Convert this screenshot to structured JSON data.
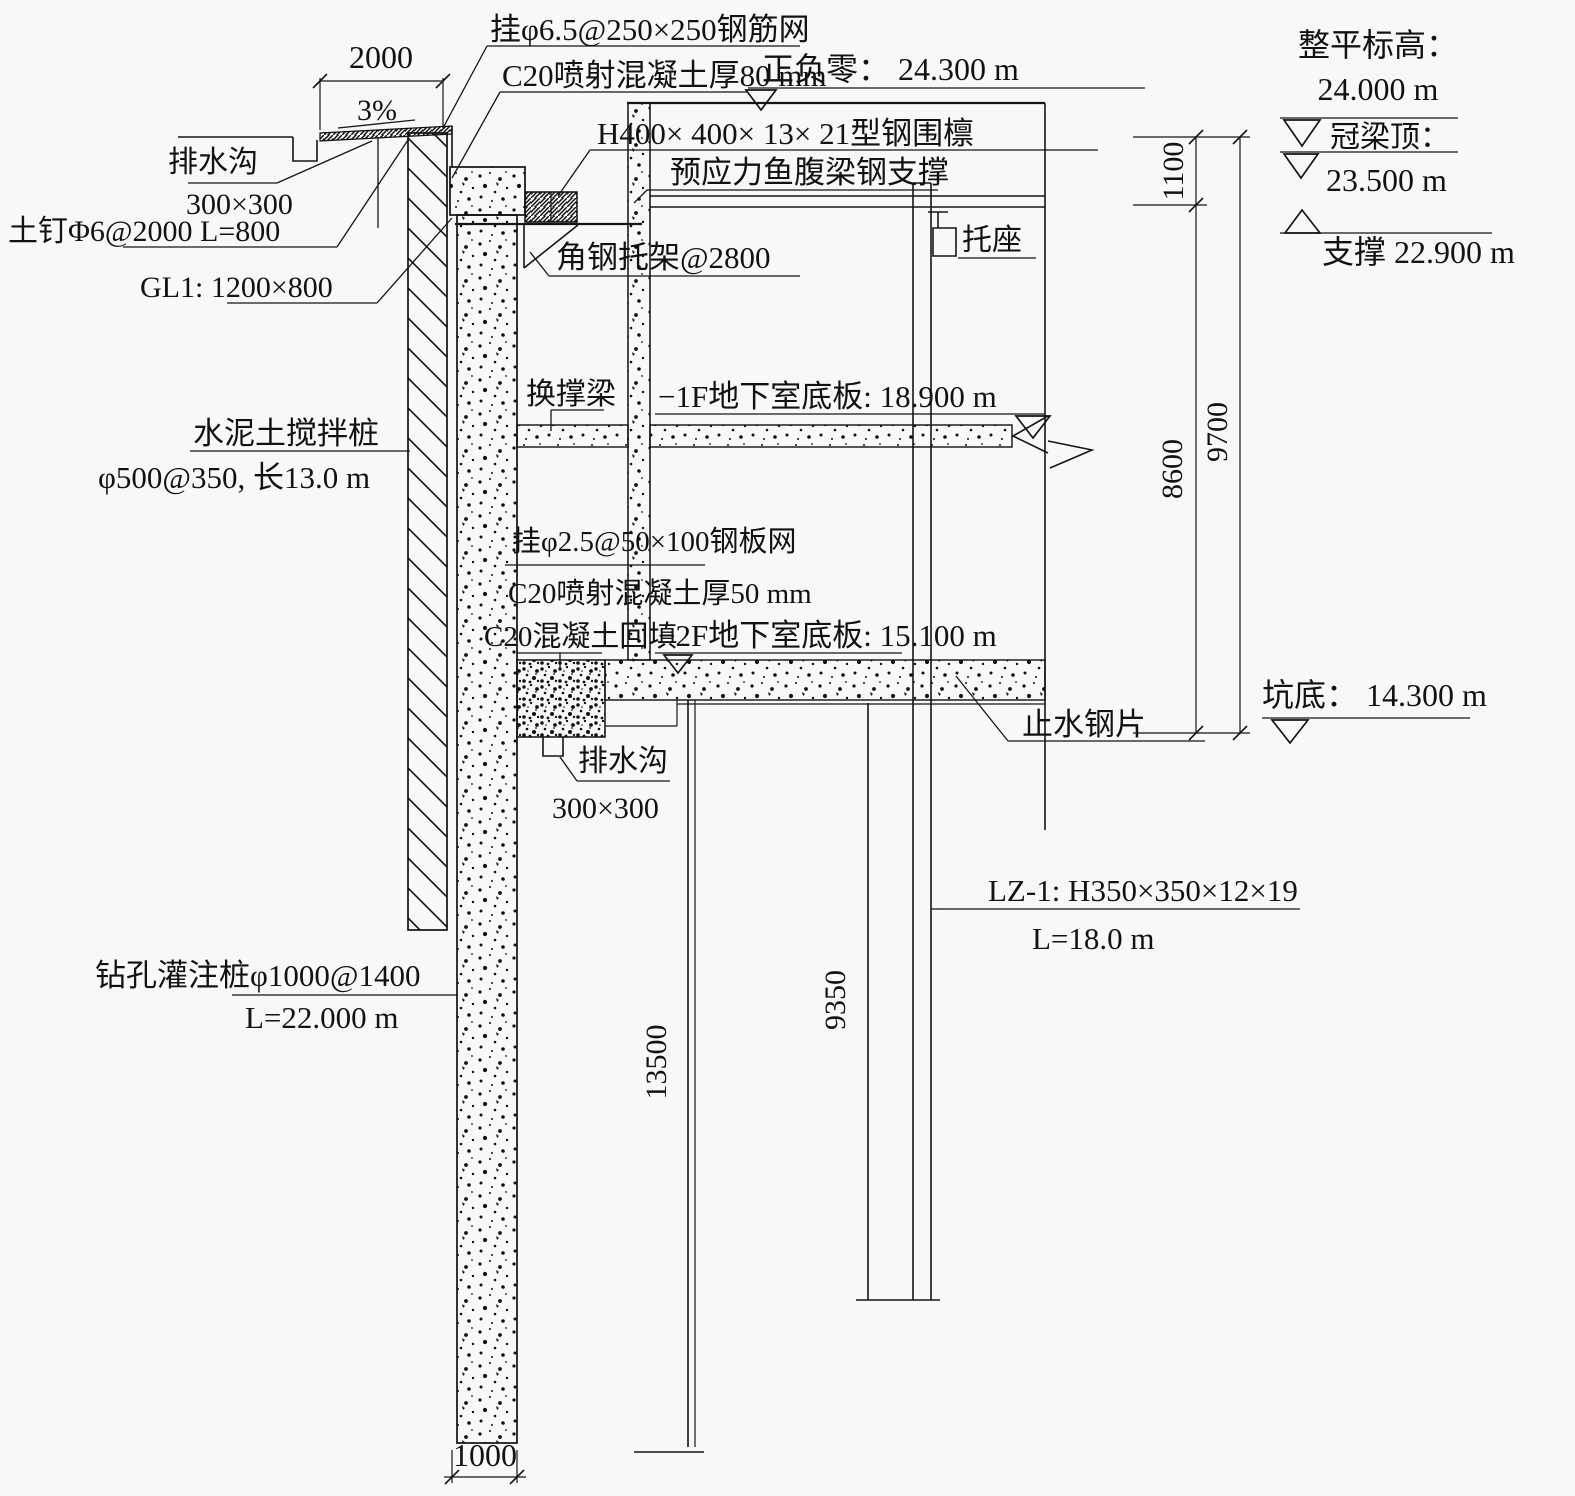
{
  "drawing": {
    "kind": "excavation-support-section",
    "top_left": {
      "slope": "3%",
      "drain_label": "排水沟",
      "drain_size": "300×300",
      "soil_nail": "土钉Φ6@2000 L=800",
      "gl1": "GL1: 1200×800"
    },
    "top_center": {
      "mesh": "挂φ6.5@250×250钢筋网",
      "shotcrete": "C20喷射混凝土厚80 mm",
      "zero_level": "正负零： 24.300 m",
      "waler": "H400× 400× 13× 21型钢围檩",
      "fish_belly": "预应力鱼腹梁钢支撑",
      "angle_bracket": "角钢托架@2800",
      "seat": "托座"
    },
    "right_levels": {
      "leveling_label": "整平标高：",
      "leveling_value": "24.000 m",
      "crown_label": "冠梁顶：",
      "crown_value": "23.500 m",
      "support_level": "支撑 22.900 m",
      "pit_bottom": "坑底： 14.300 m"
    },
    "mid": {
      "mixing_pile_1": "水泥土搅拌桩",
      "mixing_pile_2": "φ500@350, 长13.0 m",
      "transfer_beam": "换撑梁",
      "slab_1f": "−1F地下室底板: 18.900 m",
      "mesh2": "挂φ2.5@50×100钢板网",
      "shotcrete2": "C20喷射混凝土厚50 mm",
      "backfill": "C20混凝土回填",
      "slab_2f": "−2F地下室底板: 15.100 m",
      "waterstop": "止水钢片",
      "drain2_label": "排水沟",
      "drain2_size": "300×300"
    },
    "bottom": {
      "lz1_spec": "LZ-1: H350×350×12×19",
      "lz1_len": "L=18.0 m",
      "pile_spec": "钻孔灌注桩φ1000@1400",
      "pile_len": "L=22.000 m"
    },
    "dims": {
      "top_offset": "2000",
      "v1100": "1100",
      "v9700": "9700",
      "v8600": "8600",
      "v13500": "13500",
      "v9350": "9350",
      "pile_width": "1000"
    },
    "colors": {
      "ink": "#121212",
      "paper": "#f8f8f8"
    }
  }
}
